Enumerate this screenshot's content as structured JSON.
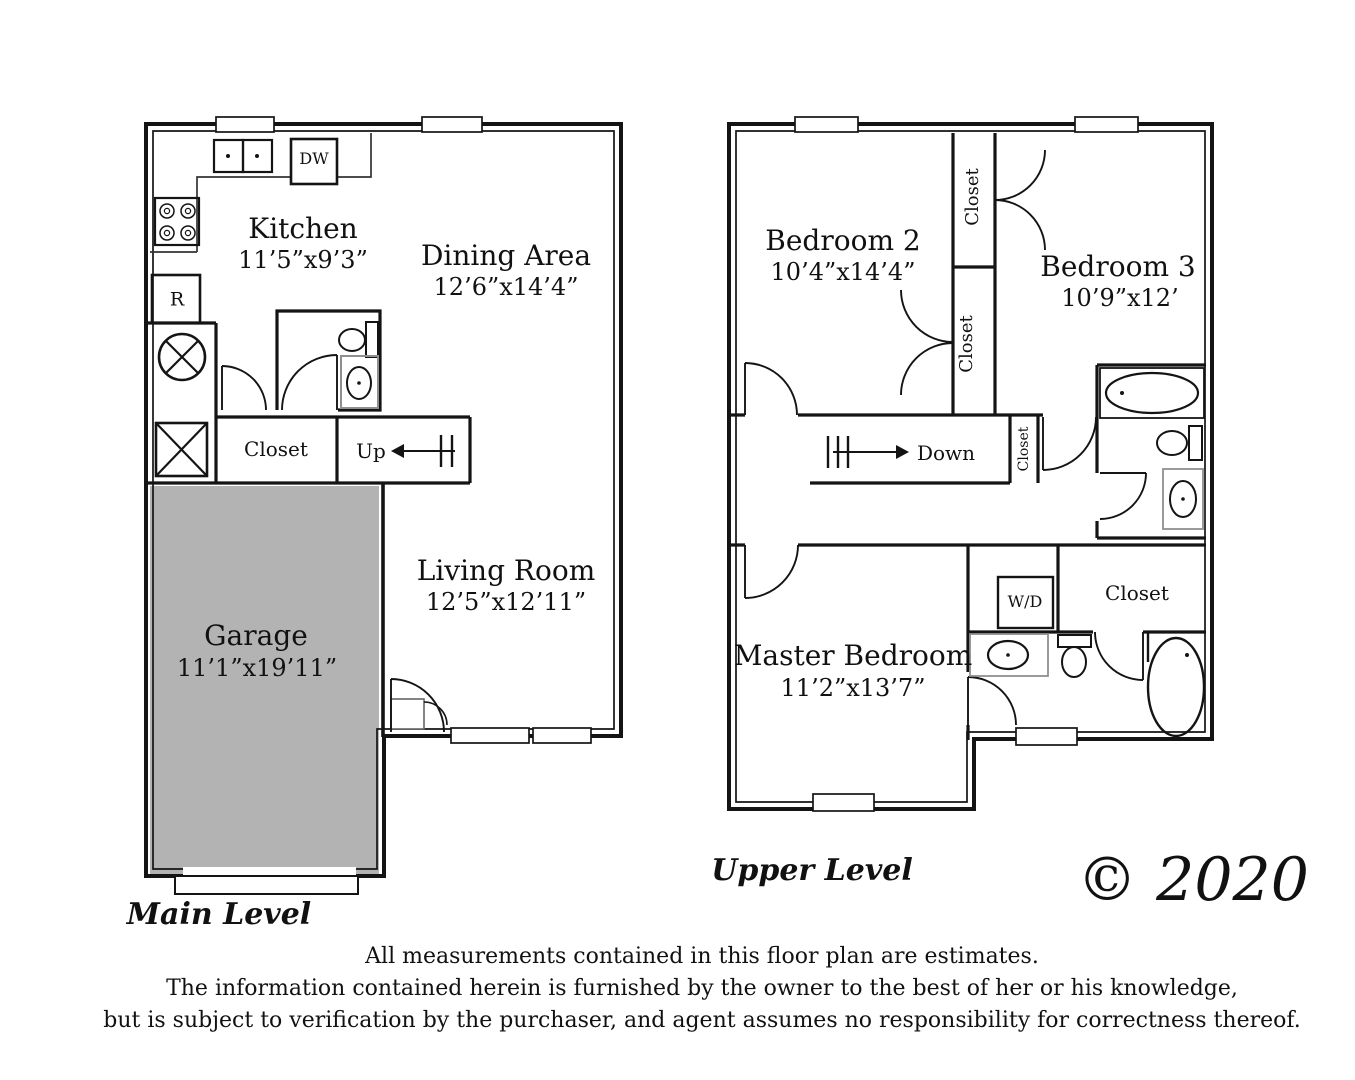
{
  "main": {
    "title": "Main Level",
    "rooms": {
      "kitchen": {
        "name": "Kitchen",
        "dims": "11’5”x9’3”"
      },
      "dining": {
        "name": "Dining Area",
        "dims": "12’6”x14’4”"
      },
      "living": {
        "name": "Living Room",
        "dims": "12’5”x12’11”"
      },
      "garage": {
        "name": "Garage",
        "dims": "11’1”x19’11”"
      }
    },
    "labels": {
      "closet": "Closet",
      "up": "Up",
      "dishwasher": "DW",
      "refrigerator": "R"
    }
  },
  "upper": {
    "title": "Upper Level",
    "rooms": {
      "bedroom2": {
        "name": "Bedroom 2",
        "dims": "10’4”x14’4”"
      },
      "bedroom3": {
        "name": "Bedroom 3",
        "dims": "10’9”x12’"
      },
      "master": {
        "name": "Master Bedroom",
        "dims": "11’2”x13’7”"
      }
    },
    "labels": {
      "closet_bedroom3": "Closet",
      "closet_bedroom2": "Closet",
      "closet_stair": "Closet",
      "closet_master": "Closet",
      "down": "Down",
      "washer_dryer": "W/D"
    }
  },
  "footer": {
    "copyright": "© 2020",
    "disclaimer": [
      "All measurements contained in this floor plan are estimates.",
      "The information contained herein is furnished by the owner to the best of her or his knowledge,",
      "but is subject to verification by the purchaser, and agent assumes no responsibility for correctness thereof."
    ]
  }
}
